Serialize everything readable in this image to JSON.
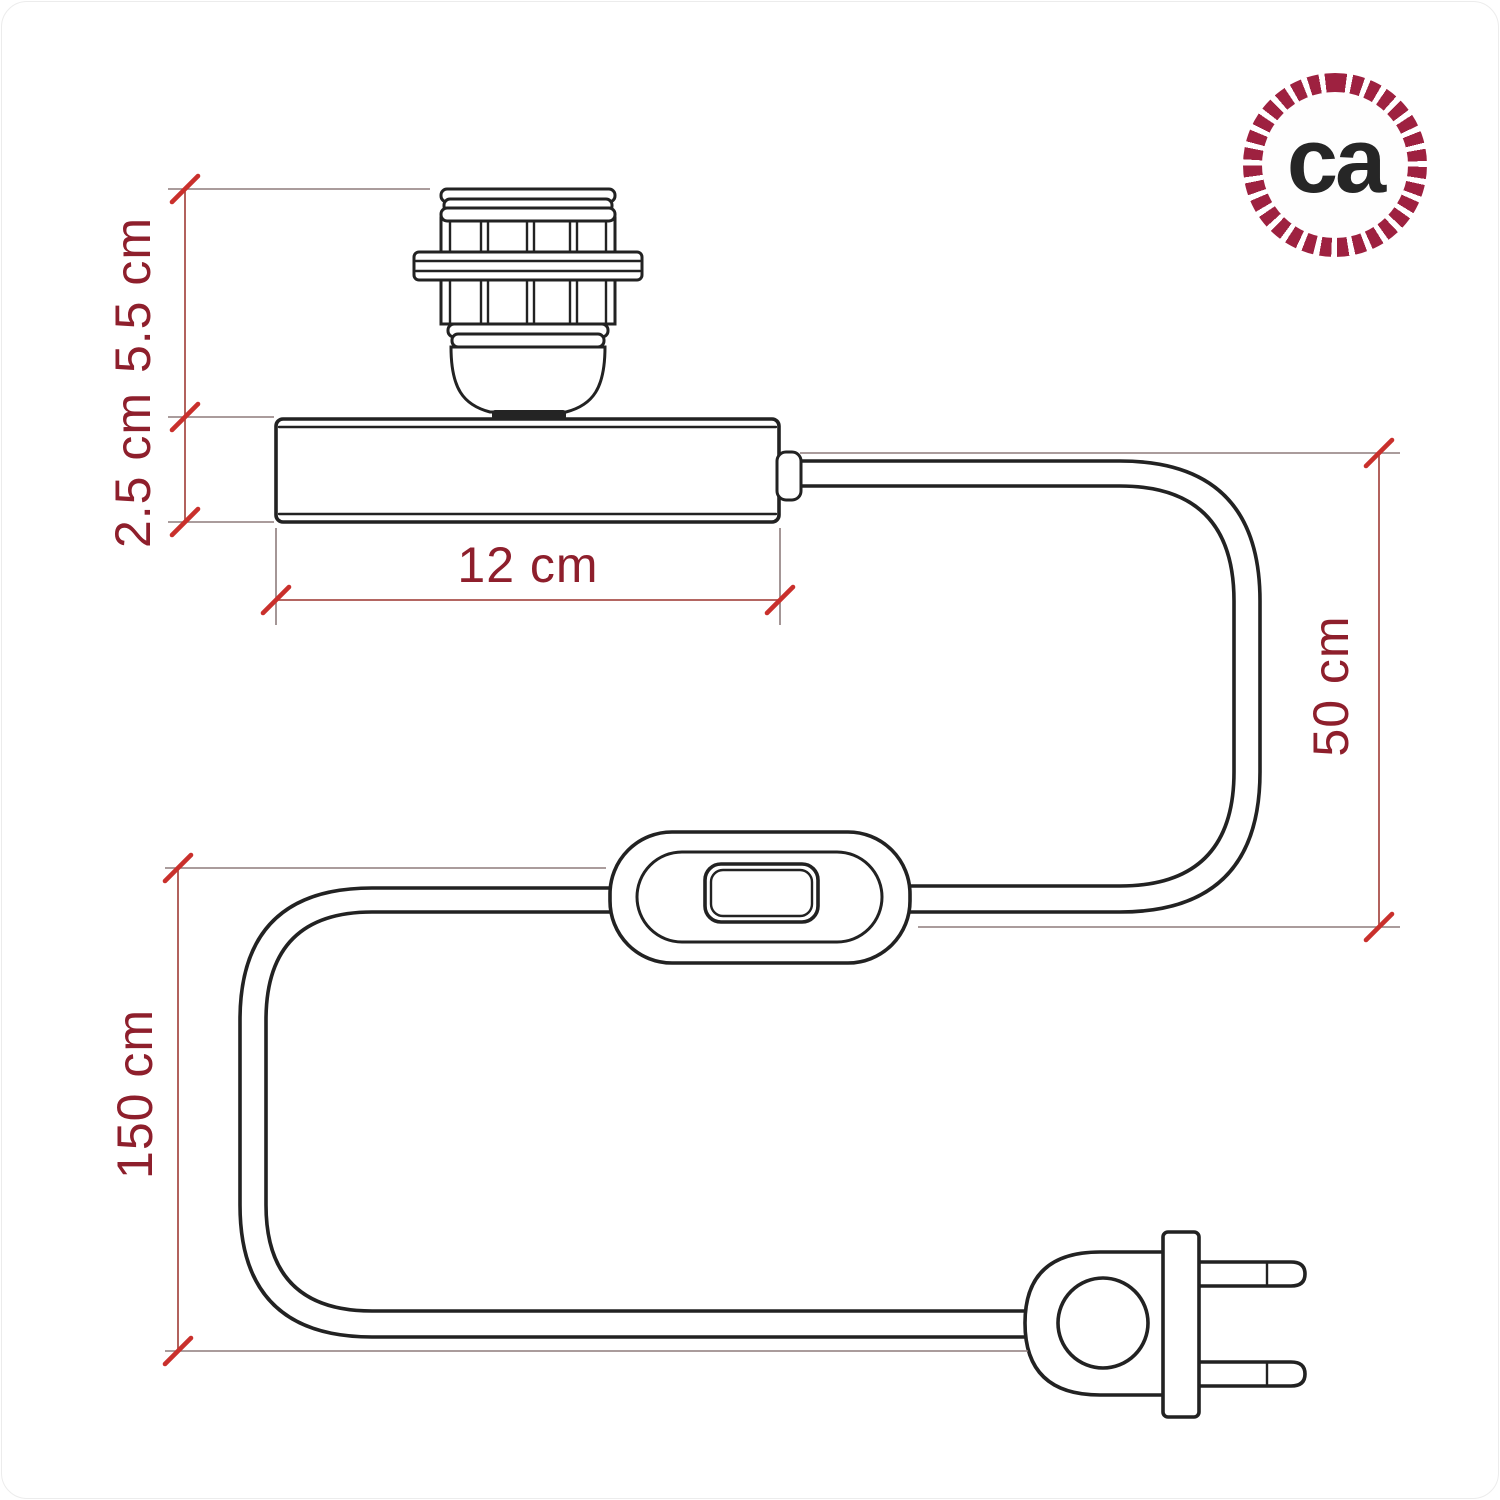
{
  "logo": {
    "text": "ca"
  },
  "dimensions": {
    "socket_height": "5.5 cm",
    "base_height": "2.5 cm",
    "base_width": "12 cm",
    "cable_to_switch": "50 cm",
    "cable_total": "150 cm"
  },
  "colors": {
    "line": "#222222",
    "dim": "#a9504b",
    "ext": "#8d7b7b",
    "tick": "#c9302c",
    "label": "#8e1f2c",
    "ring": "#9e2140",
    "logo-text": "#262626",
    "bg": "#ffffff"
  }
}
